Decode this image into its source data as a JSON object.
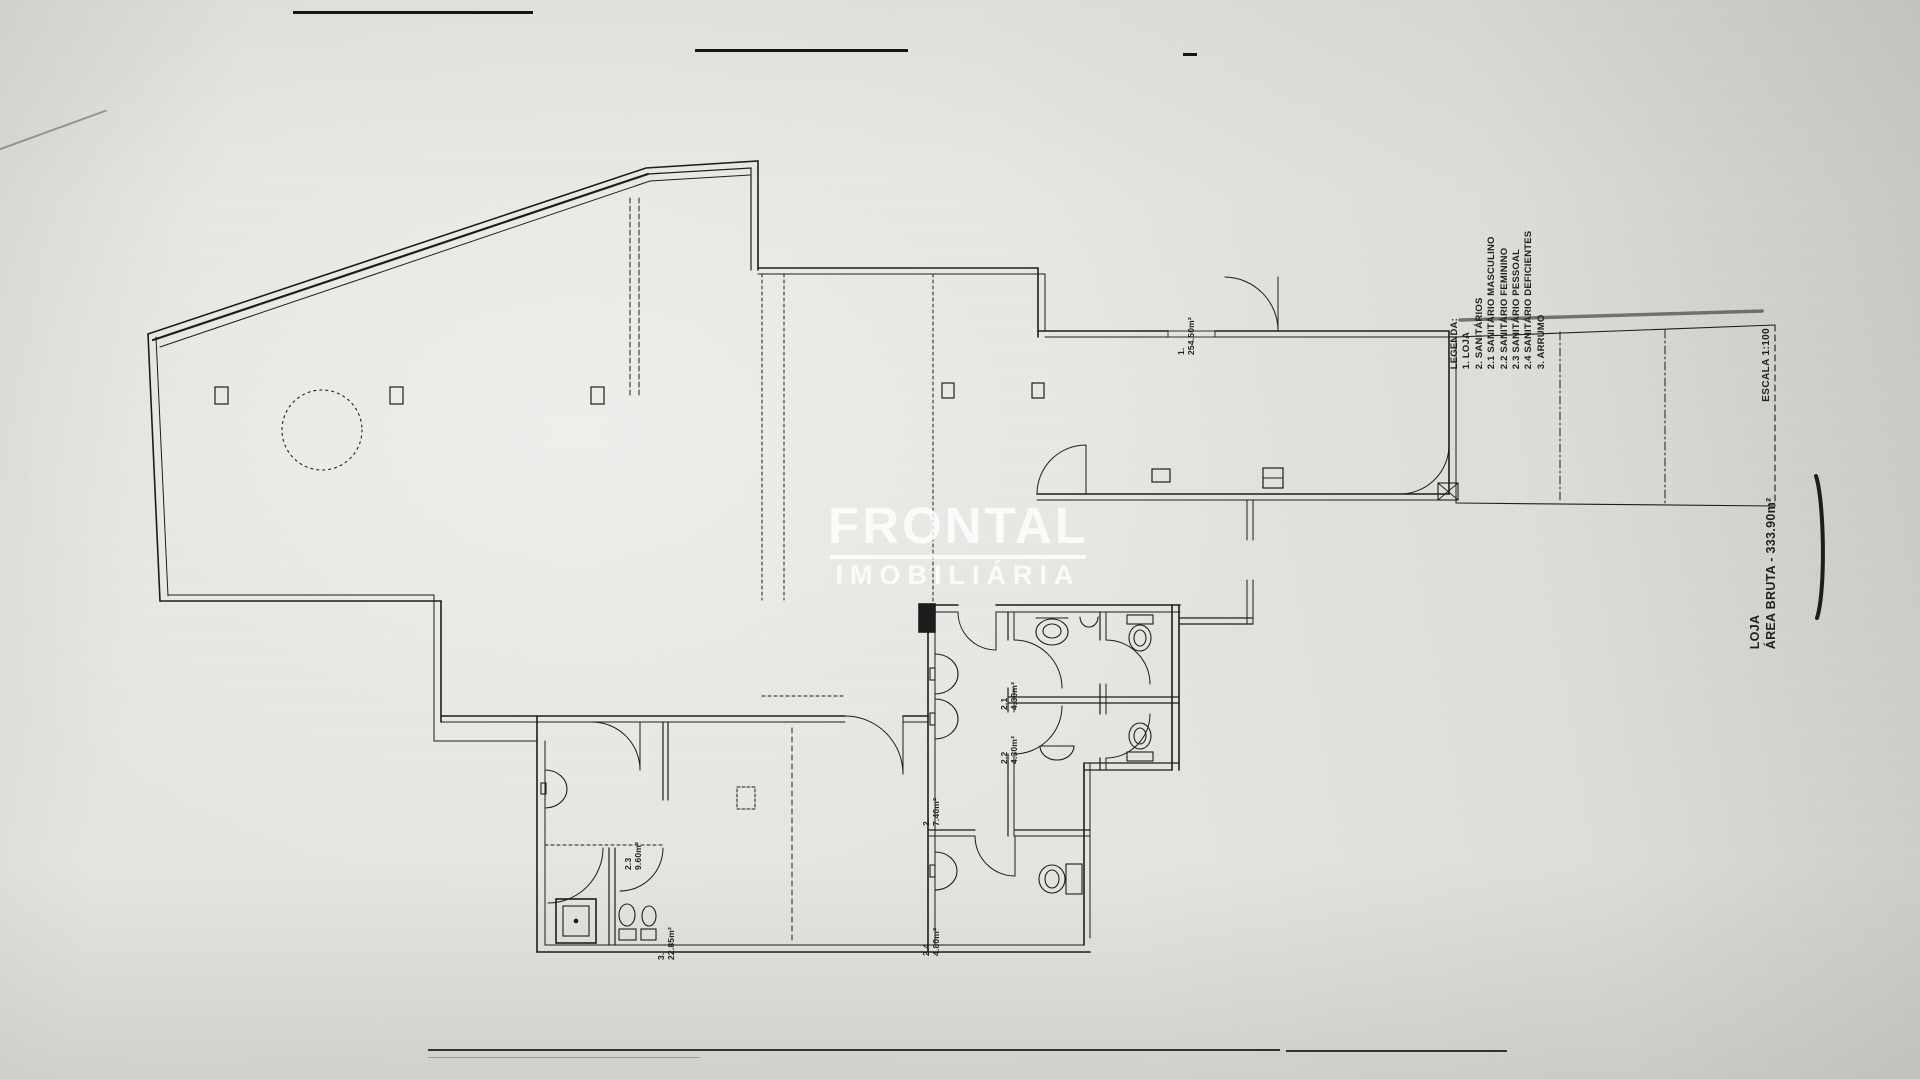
{
  "watermark": {
    "name": "FRONTAL",
    "tagline": "IMOBILIÁRIA"
  },
  "legend": {
    "title": "LEGENDA:",
    "items": [
      "1. LOJA",
      "2. SANITÁRIOS",
      "2.1 SANITÁRIO MASCULINO",
      "2.2 SANITÁRIO FEMININO",
      "2.3 SANITÁRIO PESSOAL",
      "2.4 SANITÁRIO DEFICIENTES",
      "3. ARRUMO"
    ]
  },
  "annotations": {
    "scale": "ESCALA 1:100",
    "area_label_line1": "LOJA",
    "area_label_line2": "ÁREA BRUTA - 333.90m²"
  },
  "rooms": [
    {
      "number": "1.",
      "area": "254.50m²"
    },
    {
      "number": "2.",
      "area": "7.40m²"
    },
    {
      "number": "2.1",
      "area": "4.30m²"
    },
    {
      "number": "2.2",
      "area": "4.30m²"
    },
    {
      "number": "2.3",
      "area": "9.60m²"
    },
    {
      "number": "2.4",
      "area": "4.80m²"
    },
    {
      "number": "3.",
      "area": "22.85m²"
    }
  ],
  "colors": {
    "paper": "#e6e5e1",
    "ink": "#1d1d1d",
    "watermark": "#ffffff"
  }
}
